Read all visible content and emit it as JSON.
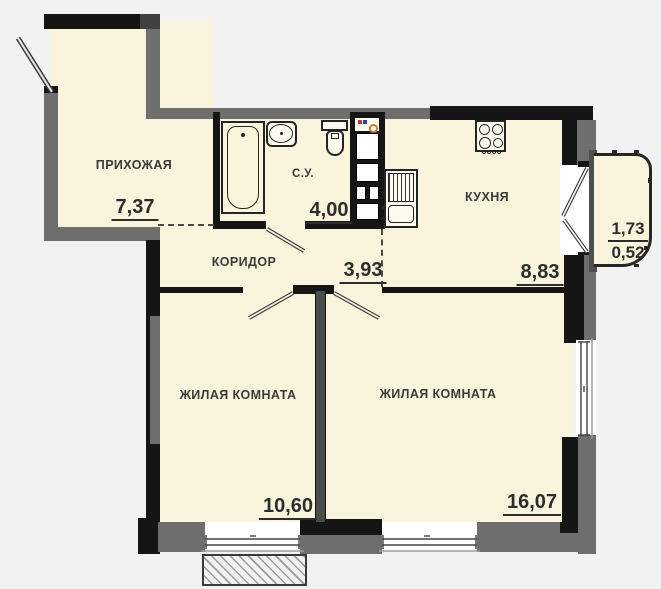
{
  "rooms": [
    {
      "name": "hallway",
      "label": "ПРИХОЖАЯ",
      "area": "7,37"
    },
    {
      "name": "bathroom",
      "label": "С.У.",
      "area": "4,00"
    },
    {
      "name": "corridor",
      "label": "КОРИДОР",
      "area": "3,93"
    },
    {
      "name": "kitchen",
      "label": "КУХНЯ",
      "area": "8,83"
    },
    {
      "name": "living-room-1",
      "label": "ЖИЛАЯ КОМНАТА",
      "area": "10,60"
    },
    {
      "name": "living-room-2",
      "label": "ЖИЛАЯ КОМНАТА",
      "area": "16,07"
    },
    {
      "name": "balcony",
      "area_total": "1,73",
      "area_counted": "0,52"
    }
  ],
  "colors": {
    "room_fill": "#faf4dc",
    "wall_dark": "#151515",
    "wall_gray": "#6e6e6e",
    "background": "#f2f2f2",
    "window_white": "#ffffff",
    "text": "#3a3a3a",
    "riser_hot": "#c03a2b",
    "riser_cold": "#2e3fae",
    "gas_ring": "#c8802a"
  }
}
